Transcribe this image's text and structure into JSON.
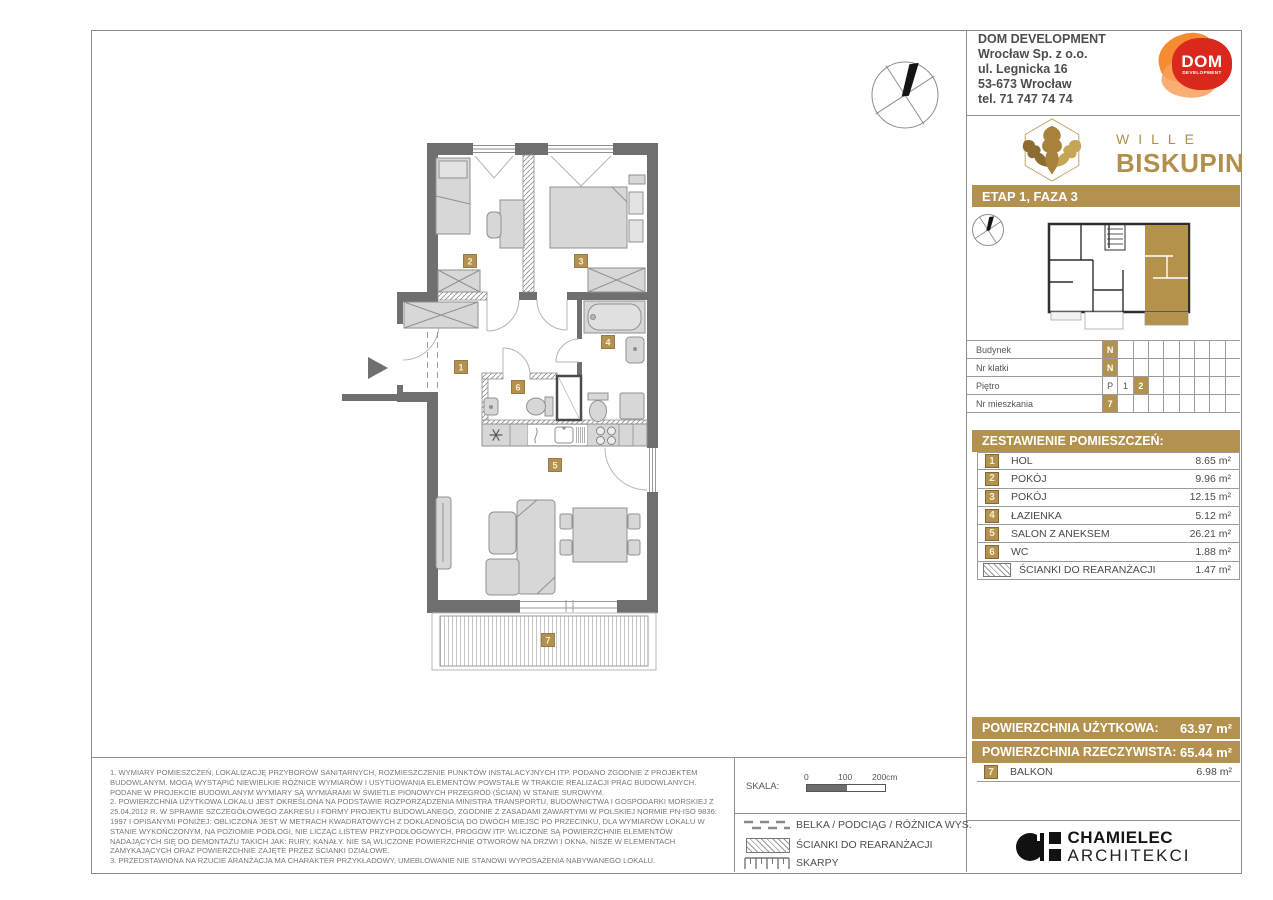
{
  "company": {
    "lines": [
      "DOM DEVELOPMENT",
      "Wrocław Sp. z o.o.",
      "ul. Legnicka 16",
      "53-673 Wrocław",
      "tel. 71 747 74 74"
    ]
  },
  "dom_logo": {
    "dom": "DOM",
    "development": "DEVELOPMENT"
  },
  "brand": {
    "line1": "WILLE",
    "line2": "BISKUPIN"
  },
  "stage_banner": "ETAP 1, FAZA 3",
  "unit": {
    "rows": [
      {
        "label": "Budynek",
        "cells": [
          "N",
          "",
          "",
          "",
          "",
          "",
          "",
          "",
          ""
        ]
      },
      {
        "label": "Nr klatki",
        "cells": [
          "N",
          "",
          "",
          "",
          "",
          "",
          "",
          "",
          ""
        ]
      },
      {
        "label": "Piętro",
        "cells": [
          "P",
          "1",
          "2",
          "",
          "",
          "",
          "",
          "",
          ""
        ]
      },
      {
        "label": "Nr mieszkania",
        "cells": [
          "7",
          "",
          "",
          "",
          "",
          "",
          "",
          "",
          ""
        ]
      }
    ]
  },
  "rooms": {
    "title": "ZESTAWIENIE POMIESZCZEŃ:",
    "items": [
      {
        "num": "1",
        "name": "HOL",
        "area": "8.65 m²"
      },
      {
        "num": "2",
        "name": "POKÓJ",
        "area": "9.96 m²"
      },
      {
        "num": "3",
        "name": "POKÓJ",
        "area": "12.15 m²"
      },
      {
        "num": "4",
        "name": "ŁAZIENKA",
        "area": "5.12 m²"
      },
      {
        "num": "5",
        "name": "SALON Z ANEKSEM",
        "area": "26.21 m²"
      },
      {
        "num": "6",
        "name": "WC",
        "area": "1.88 m²"
      }
    ],
    "rearrangement": {
      "name": "ŚCIANKI DO REARANŻACJI",
      "area": "1.47 m²"
    }
  },
  "summary": {
    "usable_label": "POWIERZCHNIA UŻYTKOWA:",
    "usable_value": "63.97 m²",
    "actual_label": "POWIERZCHNIA RZECZYWISTA:",
    "actual_value": "65.44 m²",
    "balcony": {
      "num": "7",
      "name": "BALKON",
      "area": "6.98 m²"
    }
  },
  "architect": {
    "line1": "CHAMIELEC",
    "line2": "ARCHITEKCI"
  },
  "footnotes": {
    "n1": "1.  WYMIARY POMIESZCZEŃ, LOKALIZACJĘ PRZYBORÓW SANITARNYCH, ROZMIESZCZENIE PUNKTÓW INSTALACYJNYCH ITP. PODANO ZGODNIE Z PROJEKTEM BUDOWLANYM. MOGĄ WYSTĄPIĆ NIEWIELKIE RÓŻNICE WYMIARÓW I USYTUOWANIA ELEMENTÓW POWSTAŁE W TRAKCIE REALIZACJI PRAC BUDOWLANYCH. PODANE W PROJEKCIE BUDOWLANYM WYMIARY SĄ WYMIARAMI W ŚWIETLE PIONOWYCH PRZEGRÓD (ŚCIAN) W STANIE SUROWYM.",
    "n2": "2.  POWIERZCHNIA UŻYTKOWA LOKALU JEST OKREŚLONA NA PODSTAWIE ROZPORZĄDZENIA MINISTRA TRANSPORTU, BUDOWNICTWA I GOSPODARKI MORSKIEJ Z 25.04.2012 R. W SPRAWIE SZCZEGÓŁOWEGO ZAKRESU I FORMY PROJEKTU BUDOWLANEGO, ZGODNIE Z ZASADAMI ZAWARTYMI W POLSKIEJ NORMIE PN-ISO 9836: 1997 I OPISANYMI PONIŻEJ: OBLICZONA JEST W METRACH KWADRATOWYCH Z DOKŁADNOŚCIĄ DO DWÓCH MIEJSC PO PRZECINKU, DLA WYMIARÓW LOKALU W STANIE WYKOŃCZONYM, NA POZIOMIE PODŁOGI, NIE LICZĄC LISTEW PRZYPODŁOGOWYCH, PROGÓW ITP. WLICZONE SĄ POWIERZCHNIE ELEMENTÓW NADAJĄCYCH SIĘ DO DEMONTAŻU TAKICH JAK: RURY, KANAŁY. NIE SĄ WLICZONE POWIERZCHNIE OTWORÓW NA DRZWI I OKNA, NISZE W ELEMENTACH ZAMYKAJĄCYCH ORAZ POWIERZCHNIE ZAJĘTE PRZEZ ŚCIANKI DZIAŁOWE.",
    "n3": "3.  PRZEDSTAWIONA NA RZUCIE ARANŻACJA MA CHARAKTER PRZYKŁADOWY, UMEBLOWANIE NIE STANOWI WYPOSAŻENIA NABYWANEGO LOKALU."
  },
  "scale": {
    "label": "SKALA:",
    "t0": "0",
    "t100": "100",
    "t200": "200cm"
  },
  "legend": {
    "items": [
      "BELKA / PODCIĄG / RÓŻNICA WYS.",
      "ŚCIANKI DO REARANŻACJI",
      "SKARPY"
    ]
  },
  "plan": {
    "labels": [
      "1",
      "2",
      "3",
      "4",
      "5",
      "6",
      "7"
    ]
  },
  "colors": {
    "gold": "#b3914e",
    "wall": "#6f6f6f",
    "logo_red": "#da291c",
    "logo_orange": "#f58220"
  }
}
